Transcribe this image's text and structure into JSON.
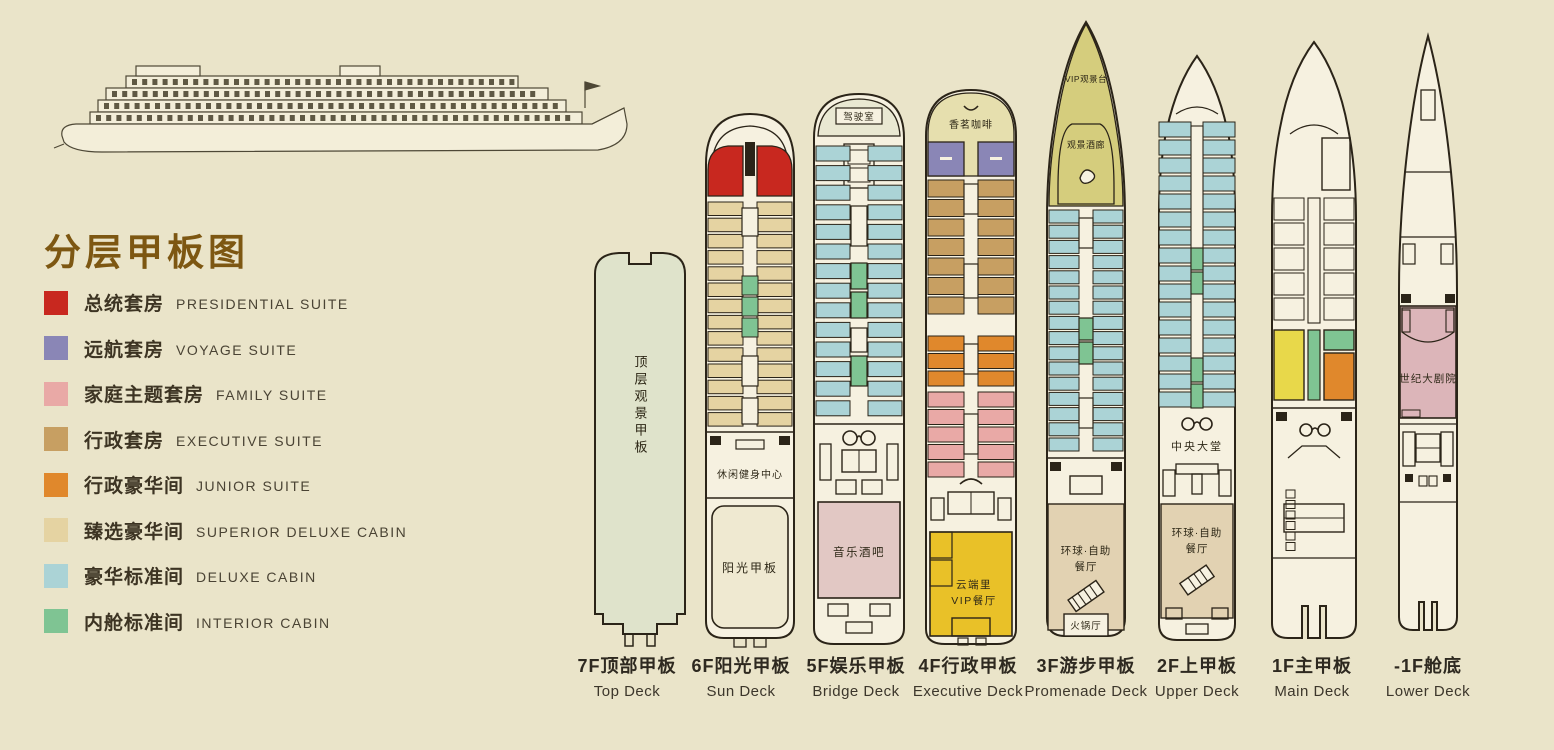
{
  "title": "分层甲板图",
  "palette": {
    "presidential": "#c8281f",
    "voyage": "#8a86b6",
    "family": "#e9a9a6",
    "executive": "#c79f62",
    "junior": "#e0882c",
    "superior": "#e5d3a2",
    "deluxe": "#abd3d6",
    "interior": "#7fc493",
    "hull": "#f6f1e0",
    "sage": "#dfe3cb",
    "sun": "#efe9d1",
    "bow_olive": "#d5cd7d",
    "bow_cream": "#e6dfae",
    "vip_yellow": "#e9c128",
    "restaurant": "#e2d2b2",
    "bar_pink": "#e2c8c4",
    "theatre_pink": "#dcb5b9",
    "kids_yellow": "#e8d84a",
    "bridge_band": "#e9e8d2",
    "window": "#5f5944",
    "outline": "#2b2418"
  },
  "legend": [
    {
      "cn": "总统套房",
      "en": "PRESIDENTIAL SUITE",
      "color": "#c8281f"
    },
    {
      "cn": "远航套房",
      "en": "VOYAGE SUITE",
      "color": "#8a86b6"
    },
    {
      "cn": "家庭主题套房",
      "en": "FAMILY SUITE",
      "color": "#e9a9a6"
    },
    {
      "cn": "行政套房",
      "en": "EXECUTIVE SUITE",
      "color": "#c79f62"
    },
    {
      "cn": "行政豪华间",
      "en": "JUNIOR SUITE",
      "color": "#e0882c"
    },
    {
      "cn": "臻选豪华间",
      "en": "SUPERIOR DELUXE CABIN",
      "color": "#e5d3a2"
    },
    {
      "cn": "豪华标准间",
      "en": "DELUXE CABIN",
      "color": "#abd3d6"
    },
    {
      "cn": "内舱标准间",
      "en": "INTERIOR CABIN",
      "color": "#7fc493"
    }
  ],
  "decks": [
    {
      "cn": "7F顶部甲板",
      "en": "Top Deck",
      "labels": {
        "area": "顶层观景甲板"
      }
    },
    {
      "cn": "6F阳光甲板",
      "en": "Sun Deck",
      "labels": {
        "gym": "休闲健身中心",
        "sun": "阳光甲板"
      }
    },
    {
      "cn": "5F娱乐甲板",
      "en": "Bridge Deck",
      "labels": {
        "bridge": "驾驶室",
        "bar": "音乐酒吧"
      }
    },
    {
      "cn": "4F行政甲板",
      "en": "Executive Deck",
      "labels": {
        "cafe": "香茗咖啡",
        "vip1": "云端里",
        "vip2": "VIP餐厅"
      }
    },
    {
      "cn": "3F游步甲板",
      "en": "Promenade Deck",
      "labels": {
        "vip_view": "VIP观景台",
        "lounge": "观景酒廊",
        "rest1": "环球·自助",
        "rest2": "餐厅",
        "hotpot": "火锅厅"
      }
    },
    {
      "cn": "2F上甲板",
      "en": "Upper Deck",
      "labels": {
        "lobby": "中央大堂",
        "rest1": "环球·自助",
        "rest2": "餐厅"
      }
    },
    {
      "cn": "1F主甲板",
      "en": "Main Deck",
      "labels": {}
    },
    {
      "cn": "-1F舱底",
      "en": "Lower Deck",
      "labels": {
        "theatre": "世纪大剧院"
      }
    }
  ]
}
